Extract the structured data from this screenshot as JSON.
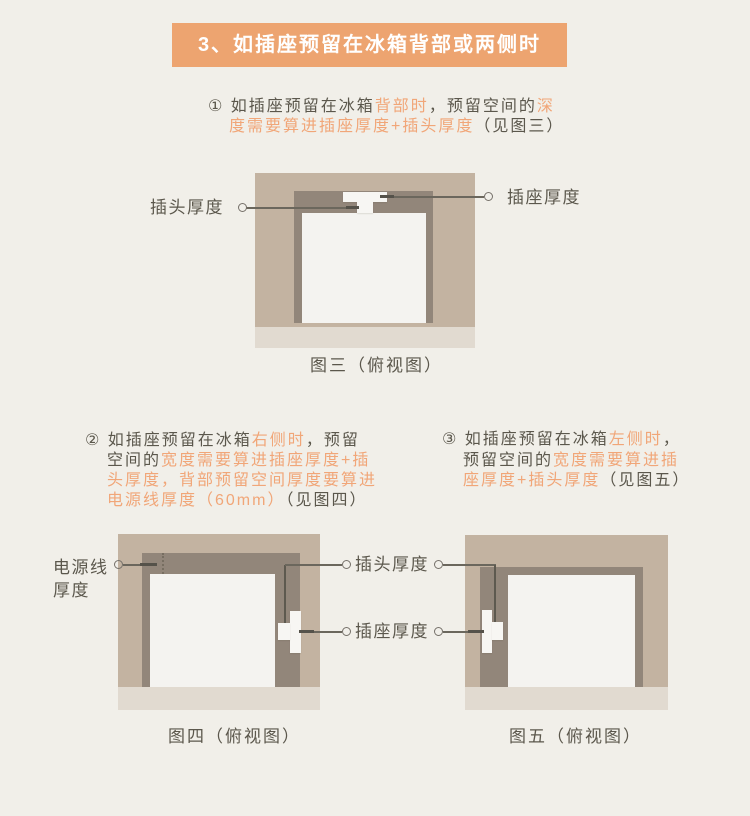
{
  "banner": {
    "text": "3、如插座预留在冰箱背部或两侧时"
  },
  "colors": {
    "page_bg": "#f1efe9",
    "banner_bg": "#eda470",
    "banner_text": "#ffffff",
    "dark_text": "#5b574c",
    "orange_text": "#f1a678",
    "wall_tan": "#c3b3a1",
    "wall_dark": "#92867a",
    "floor": "#e1dad0",
    "fridge_white": "#f4f3f0",
    "callout_line": "#6b675d"
  },
  "para1": {
    "lines": [
      [
        {
          "t": "① 如插座预留在冰箱",
          "c": "dark"
        },
        {
          "t": "背部时",
          "c": "orange"
        },
        {
          "t": "，预留空间的",
          "c": "dark"
        },
        {
          "t": "深",
          "c": "orange"
        }
      ],
      [
        {
          "t": "度需要算进插座厚度+插头厚度",
          "c": "orange"
        },
        {
          "t": "（见图三）",
          "c": "dark"
        }
      ]
    ]
  },
  "para2": {
    "lines": [
      [
        {
          "t": "② 如插座预留在冰箱",
          "c": "dark"
        },
        {
          "t": "右侧时",
          "c": "orange"
        },
        {
          "t": "，预留",
          "c": "dark"
        }
      ],
      [
        {
          "t": "空间的",
          "c": "dark"
        },
        {
          "t": "宽度需要算进插座厚度+插",
          "c": "orange"
        }
      ],
      [
        {
          "t": "头厚度，背部预留空间厚度要算进",
          "c": "orange"
        }
      ],
      [
        {
          "t": "电源线厚度（60mm）",
          "c": "orange"
        },
        {
          "t": "（见图四）",
          "c": "dark"
        }
      ]
    ]
  },
  "para3": {
    "lines": [
      [
        {
          "t": "③ 如插座预留在冰箱",
          "c": "dark"
        },
        {
          "t": "左侧时",
          "c": "orange"
        },
        {
          "t": "，",
          "c": "dark"
        }
      ],
      [
        {
          "t": "预留空间的",
          "c": "dark"
        },
        {
          "t": "宽度需要算进插",
          "c": "orange"
        }
      ],
      [
        {
          "t": "座厚度+插头厚度",
          "c": "orange"
        },
        {
          "t": "（见图五）",
          "c": "dark"
        }
      ]
    ]
  },
  "fig3": {
    "plug_label": "插头厚度",
    "socket_label": "插座厚度",
    "caption": "图三（俯视图）"
  },
  "fig4": {
    "cord_label_line1": "电源线",
    "cord_label_line2": "厚度",
    "caption": "图四（俯视图）"
  },
  "fig5": {
    "caption": "图五（俯视图）"
  },
  "shared_labels": {
    "plug": "插头厚度",
    "socket": "插座厚度"
  }
}
